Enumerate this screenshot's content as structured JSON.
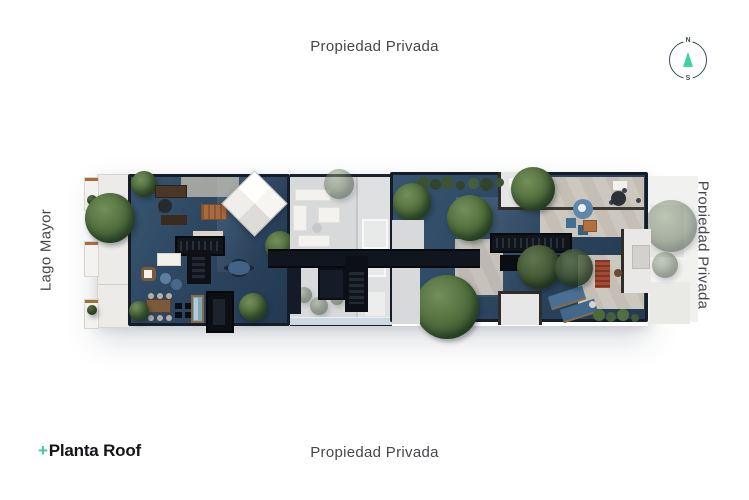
{
  "labels": {
    "top": "Propiedad Privada",
    "bottom": "Propiedad Privada",
    "right": "Propiedad Privada",
    "left": "Lago Mayor"
  },
  "logo": {
    "plus": "+",
    "title": "Planta Roof"
  },
  "compass": {
    "north": "N",
    "south": "S"
  },
  "colors": {
    "accent_teal": "#3ec9a7",
    "compass_ring": "#3e4a57",
    "label_text": "#46474b",
    "logo_text": "#131519",
    "roof_navy": "#2c4560",
    "roof_wall_dark": "#151d29",
    "concrete": "#c8c3ba",
    "courtyard_faded": "#d8d9da",
    "tree_green": "#53703f",
    "wood_accent": "#a96a3e",
    "red_lounger": "#a44a30",
    "pool_blue": "#7fa8bf",
    "water_strip": "#ccd9e1"
  },
  "plan": {
    "features": [
      "left-wing-roof-terrace",
      "pyramid-skylight",
      "facade-balconies",
      "central-courtyard",
      "walkway-bridge",
      "stairwells",
      "right-wing-roof-terrace",
      "patios",
      "trees",
      "loungers",
      "plunge-pool"
    ]
  }
}
